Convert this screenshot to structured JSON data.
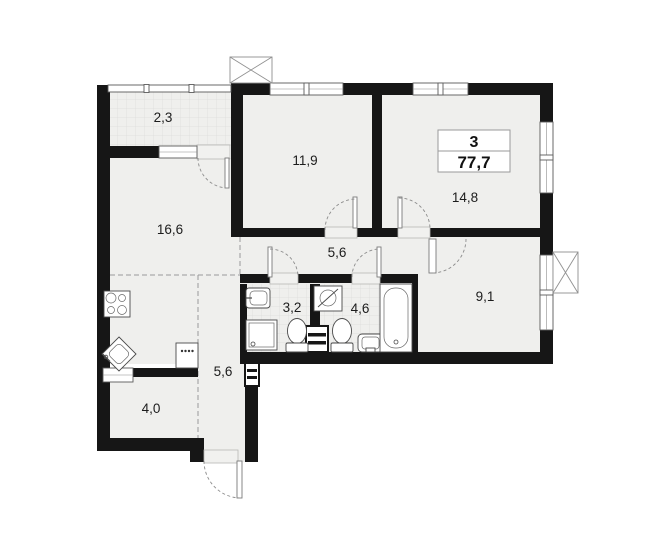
{
  "plan": {
    "info": {
      "rooms_count": "3",
      "total_area": "77,7"
    },
    "rooms": [
      {
        "id": "balcony",
        "area": "2,3"
      },
      {
        "id": "room-1",
        "area": "11,9"
      },
      {
        "id": "room-2",
        "area": "14,8"
      },
      {
        "id": "kitchen-living",
        "area": "16,6"
      },
      {
        "id": "hallway",
        "area": "5,6"
      },
      {
        "id": "wc",
        "area": "3,2"
      },
      {
        "id": "bathroom",
        "area": "4,6"
      },
      {
        "id": "room-3",
        "area": "9,1"
      },
      {
        "id": "corridor",
        "area": "5,6"
      },
      {
        "id": "storage",
        "area": "4,0"
      }
    ],
    "fixtures": [
      "stove-symbol",
      "kitchen-sink-symbol",
      "appliance-symbol",
      "shower-tray-symbol",
      "wall-sink-symbol",
      "toilet-symbol",
      "washing-machine-symbol",
      "bathroom-sink-symbol",
      "bathtub-symbol",
      "vent-shaft-symbol",
      "duct-symbol",
      "entrance-door-symbol",
      "window-symbol"
    ],
    "colors": {
      "wall": "#161616",
      "floor": "#efefed",
      "tile_line": "#dcdcda",
      "background": "#ffffff",
      "label_text": "#1c1c1c"
    }
  }
}
